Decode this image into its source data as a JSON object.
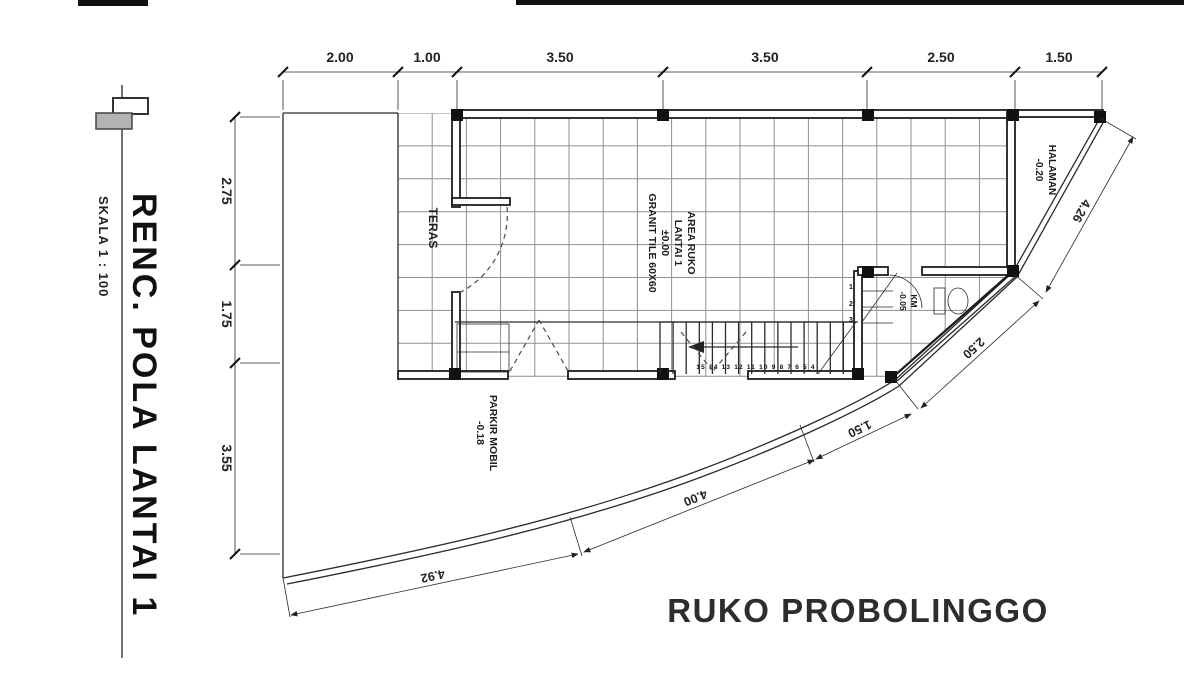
{
  "title_block": {
    "drawing_title": "RENC. POLA LANTAI 1",
    "scale_label": "SKALA 1 : 100"
  },
  "project_title": "RUKO PROBOLINGGO",
  "dimensions": {
    "top": [
      "2.00",
      "1.00",
      "3.50",
      "3.50",
      "2.50",
      "1.50"
    ],
    "left": [
      "2.75",
      "1.75",
      "3.55"
    ],
    "boundary": [
      "4.92",
      "4.00",
      "1.50",
      "2.50",
      "4.26"
    ]
  },
  "rooms": {
    "teras": {
      "name": "TERAS"
    },
    "ruko": {
      "name": "AREA RUKO",
      "line2": "LANTAI 1",
      "level": "±0.00",
      "finish": "GRANIT TILE 60X60"
    },
    "km": {
      "name": "KM",
      "level": "-0.05"
    },
    "halaman": {
      "name": "HALAMAN",
      "level": "-0.20"
    },
    "parkir": {
      "name": "PARKIR MOBIL",
      "level": "-0.18"
    }
  },
  "stairs": {
    "run_numbers": "15 14 13 12 11 10 9 8 7 6 5 4",
    "landing_numbers": [
      "1",
      "2",
      "3"
    ]
  },
  "colors": {
    "ink": "#2a2a2a",
    "grid": "#8f8f8f",
    "background": "#ffffff"
  }
}
